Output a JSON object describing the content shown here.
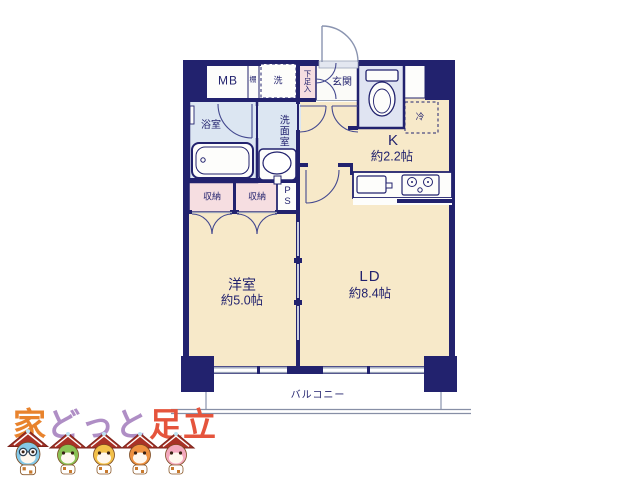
{
  "plan": {
    "labels": {
      "mb": "MB",
      "shelf": "棚",
      "washer": "洗",
      "shoe": "下足入",
      "entrance": "玄関",
      "bath": "浴室",
      "wash": "洗面室",
      "storage_a": "収納",
      "storage_b": "収納",
      "ps": "PS",
      "fridge": "冷",
      "kitchen": "K",
      "kitchen_size": "約2.2帖",
      "western": "洋室",
      "western_size": "約5.0帖",
      "ld": "LD",
      "ld_size": "約8.4帖",
      "balcony": "バルコニー"
    },
    "colors": {
      "wall": "#22226E",
      "floor": "#F7E9C9",
      "wet_room": "#DCE6F2",
      "toilet_room": "#E0E4F2",
      "storage_pink": "#F6DEE1",
      "window_gray": "#9AA3B8"
    }
  },
  "logo": {
    "parts": [
      {
        "text": "家",
        "color": "#E8832D"
      },
      {
        "text": "どっと",
        "color": "#AF8EC5"
      },
      {
        "text": "足立",
        "color": "#E5543C"
      }
    ],
    "mascots": [
      {
        "name": "blue-house-mascot",
        "color": "#85C9E8"
      },
      {
        "name": "green-house-mascot",
        "color": "#8CC255"
      },
      {
        "name": "yellow-house-mascot",
        "color": "#F2C04A"
      },
      {
        "name": "orange-house-mascot",
        "color": "#EE9140"
      },
      {
        "name": "pink-house-mascot",
        "color": "#F3A8BD"
      }
    ],
    "roof_color": "#A93226"
  }
}
